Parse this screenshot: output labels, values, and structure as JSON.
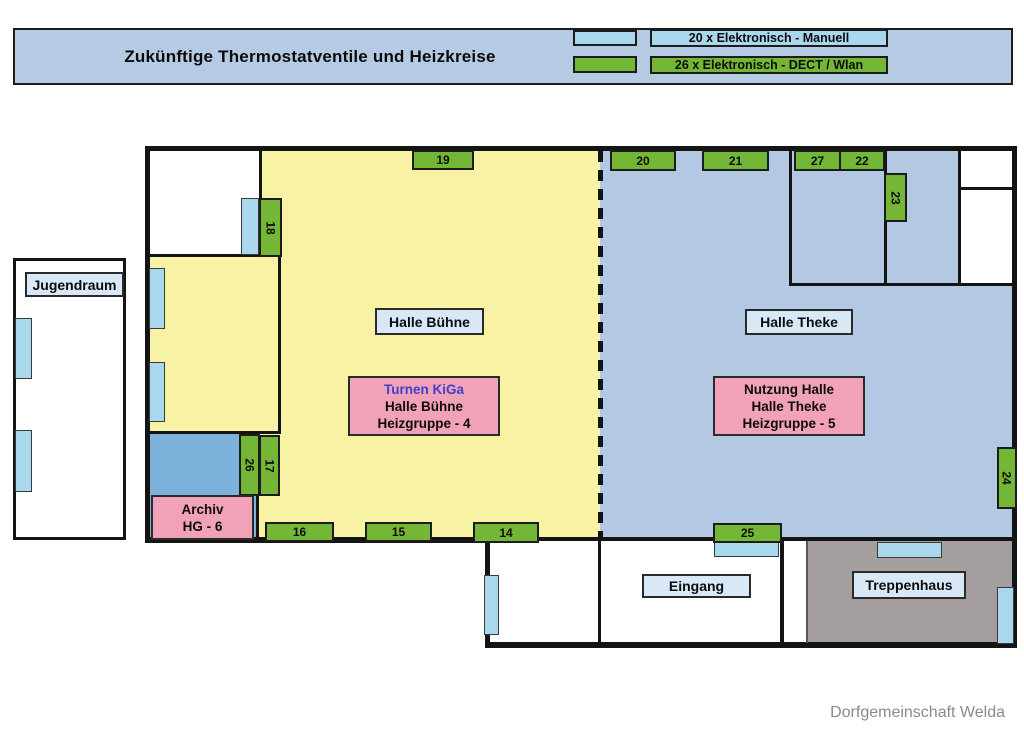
{
  "header": {
    "title": "Zukünftige Thermostatventile und Heizkreise",
    "legend": [
      {
        "name": "manuell",
        "swatch_color": "#a9d8ec",
        "label": "20 x Elektronisch - Manuell"
      },
      {
        "name": "dect-wlan",
        "swatch_color": "#74b737",
        "label": "26 x Elektronisch - DECT / Wlan"
      }
    ]
  },
  "rooms": {
    "jugendraum": "Jugendraum",
    "halle_buehne": "Halle Bühne",
    "halle_theke": "Halle Theke",
    "eingang": "Eingang",
    "treppenhaus": "Treppenhaus"
  },
  "zones": {
    "turnen": {
      "line1": "Turnen KiGa",
      "line2": "Halle Bühne",
      "line3": "Heizgruppe - 4"
    },
    "nutzung": {
      "line1": "Nutzung Halle",
      "line2": "Halle Theke",
      "line3": "Heizgruppe - 5"
    },
    "archiv": {
      "line1": "Archiv",
      "line2": "HG - 6"
    }
  },
  "valves": {
    "v14": "14",
    "v15": "15",
    "v16": "16",
    "v17": "17",
    "v18": "18",
    "v19": "19",
    "v20": "20",
    "v21": "21",
    "v22": "22",
    "v23": "23",
    "v24": "24",
    "v25": "25",
    "v26": "26",
    "v27": "27"
  },
  "colors": {
    "header_bg": "#b5cbe3",
    "zone_yellow": "#f7f2a4",
    "zone_blue": "#b3c8e3",
    "archiv_blue": "#7db3da",
    "treppenhaus_gray": "#a49e9e",
    "valve_green": "#74b737",
    "radiator_cyan": "#a9d8ec",
    "label_bg": "#d9e8f7",
    "pink_box": "#f2a2b8",
    "turnen_text_blue": "#4040c8",
    "footer_gray": "#8a8a8a"
  },
  "footer": "Dorfgemeinschaft Welda"
}
